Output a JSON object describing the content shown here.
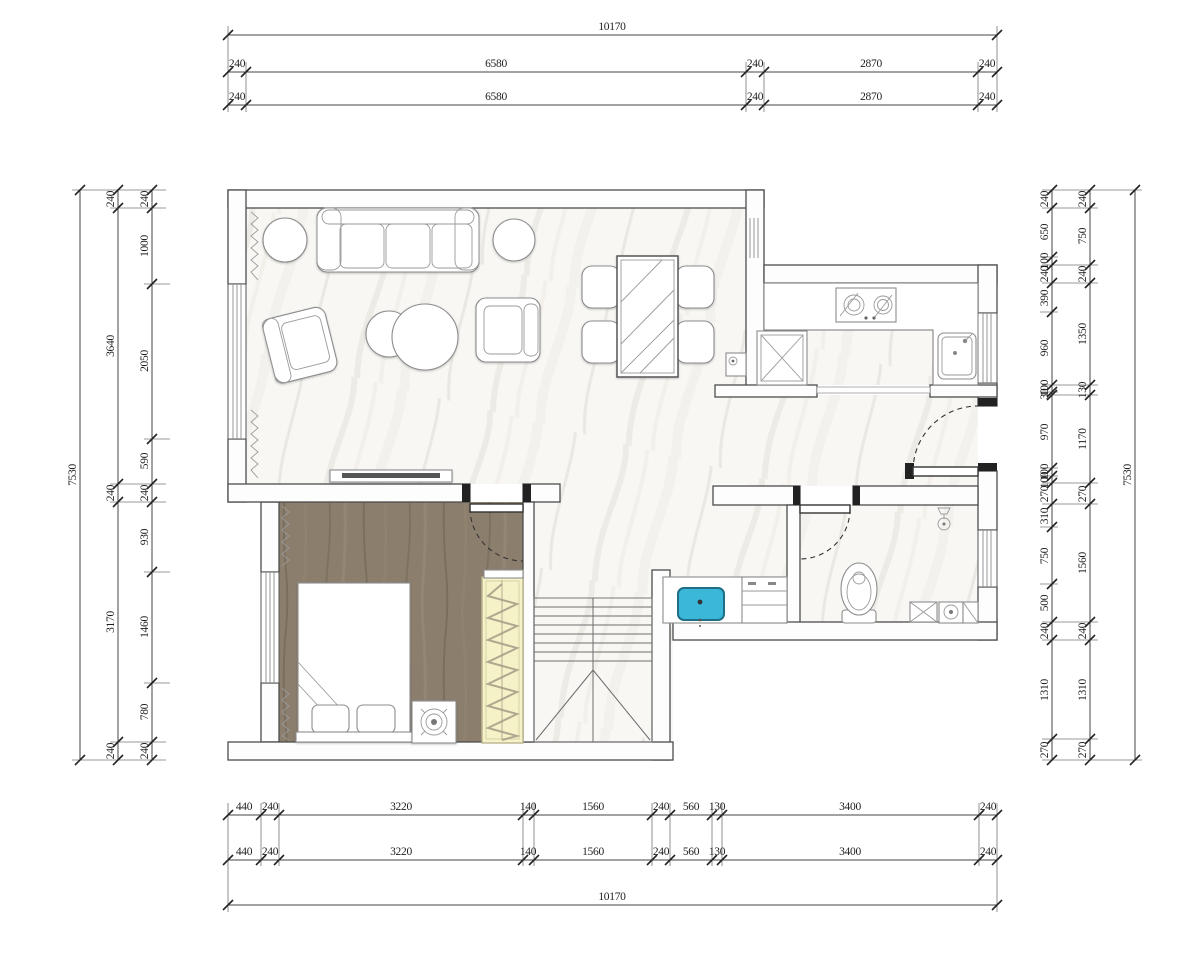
{
  "drawing": {
    "title": "apartment-floor-plan",
    "units": "mm"
  },
  "dims": {
    "top": {
      "overall": "10170",
      "rowA": [
        "240",
        "6580",
        "240",
        "2870",
        "240"
      ],
      "rowB": [
        "240",
        "6580",
        "240",
        "2870",
        "240"
      ]
    },
    "bottom": {
      "rowA": [
        "440",
        "240",
        "3220",
        "140",
        "1560",
        "240",
        "560",
        "130",
        "3400",
        "240"
      ],
      "rowB": [
        "440",
        "240",
        "3220",
        "140",
        "1560",
        "240",
        "560",
        "130",
        "3400",
        "240"
      ],
      "overall": "10170"
    },
    "left": {
      "overall": "7530",
      "mid": [
        "240",
        "3640",
        "240",
        "3170",
        "240"
      ],
      "inner": [
        "240",
        "1000",
        "2050",
        "590",
        "240",
        "930",
        "1460",
        "780",
        "240"
      ]
    },
    "right": {
      "overall": "7530",
      "outer": [
        "240",
        "750",
        "240",
        "1350",
        "130",
        "1170",
        "270",
        "1560",
        "240",
        "1310",
        "270"
      ],
      "inner": [
        "240",
        "650",
        "100",
        "240",
        "390",
        "960",
        "100",
        "30",
        "970",
        "100",
        "100",
        "270",
        "310",
        "750",
        "500",
        "240",
        "1310",
        "270"
      ]
    }
  },
  "colors": {
    "marble_floor": "#f8f7f4",
    "wood_floor": "#8b7e6d",
    "wardrobe_fill": "#f6f2c8",
    "sink_fill": "#3ab7d9",
    "wall_line": "#4c4c4c",
    "dimension_text": "#1f1f1f"
  }
}
